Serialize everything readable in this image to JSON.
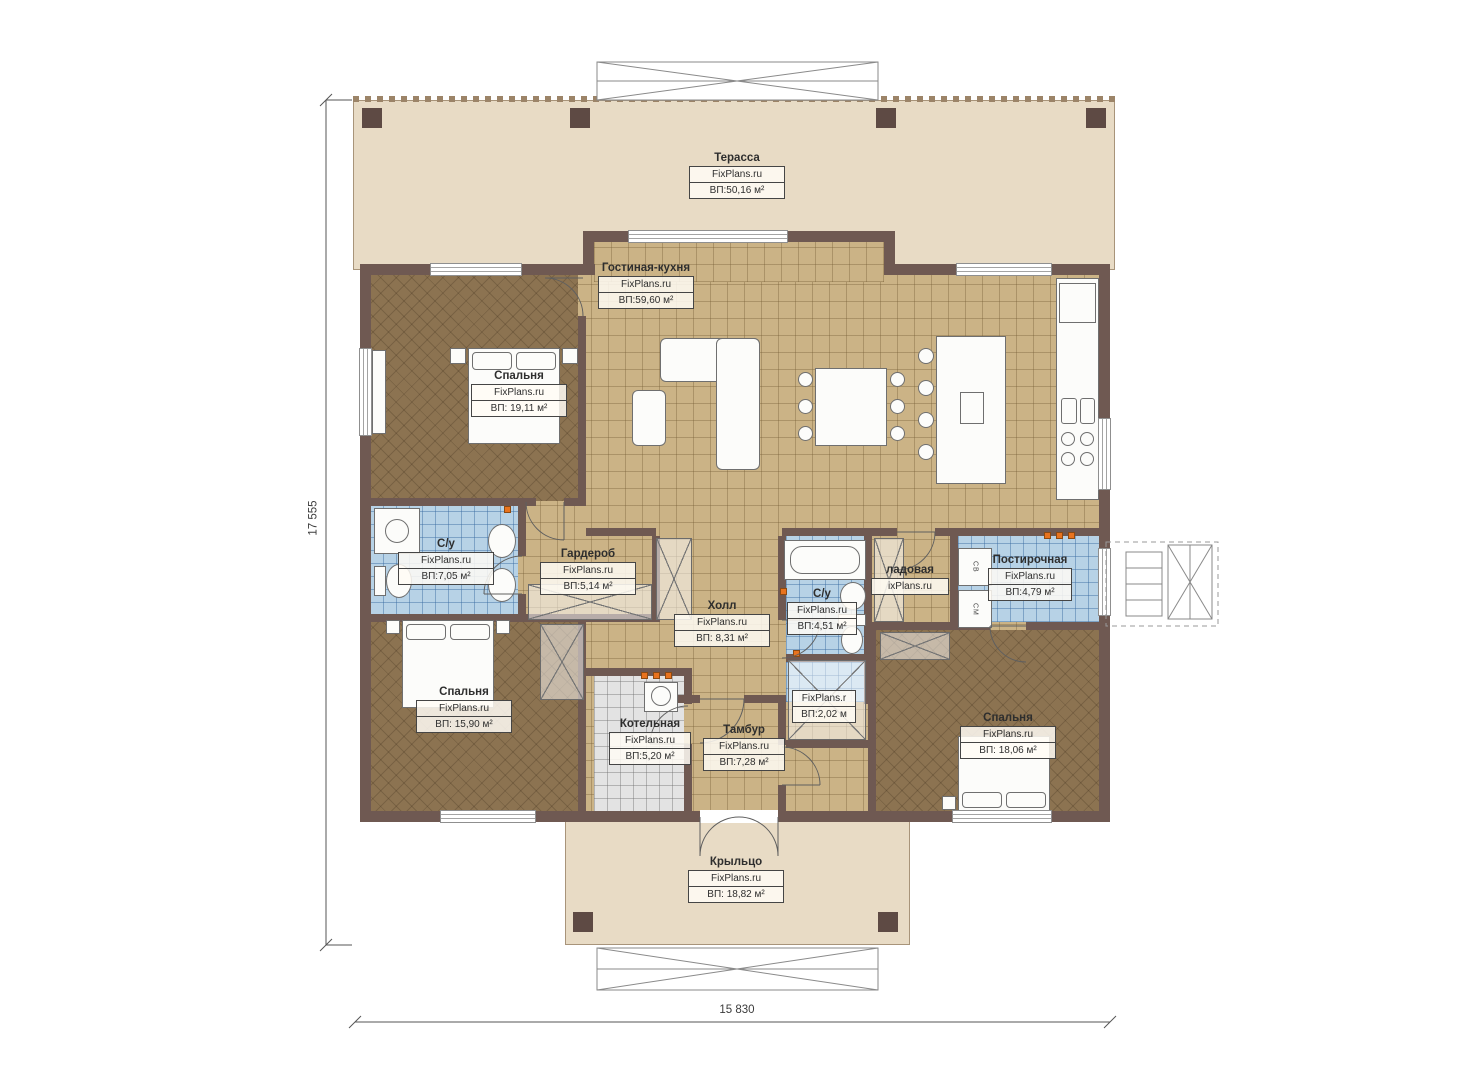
{
  "plan": {
    "dimensions": {
      "width": "15 830",
      "height": "17 555"
    },
    "rooms": [
      {
        "id": "terrace",
        "name": "Терасса",
        "brand": "FixPlans.ru",
        "area": "ВП:50,16 м²"
      },
      {
        "id": "living-kitchen",
        "name": "Гостиная-кухня",
        "brand": "FixPlans.ru",
        "area": "ВП:59,60 м²"
      },
      {
        "id": "bedroom-1",
        "name": "Спальня",
        "brand": "FixPlans.ru",
        "area": "ВП: 19,11 м²"
      },
      {
        "id": "bathroom-1",
        "name": "С/у",
        "brand": "FixPlans.ru",
        "area": "ВП:7,05 м²"
      },
      {
        "id": "wardrobe-room",
        "name": "Гардероб",
        "brand": "FixPlans.ru",
        "area": "ВП:5,14 м²"
      },
      {
        "id": "hall",
        "name": "Холл",
        "brand": "FixPlans.ru",
        "area": "ВП: 8,31 м²"
      },
      {
        "id": "bathroom-2",
        "name": "С/у",
        "brand": "FixPlans.ru",
        "area": "ВП:4,51 м²"
      },
      {
        "id": "pantry",
        "name": "ладовая",
        "brand": "ixPlans.ru",
        "area": ""
      },
      {
        "id": "laundry",
        "name": "Постирочная",
        "brand": "FixPlans.ru",
        "area": "ВП:4,79 м²"
      },
      {
        "id": "bedroom-2",
        "name": "Спальня",
        "brand": "FixPlans.ru",
        "area": "ВП: 15,90 м²"
      },
      {
        "id": "boiler-room",
        "name": "Котельная",
        "brand": "FixPlans.ru",
        "area": "ВП:5,20 м²"
      },
      {
        "id": "vestibule",
        "name": "Тамбур",
        "brand": "FixPlans.ru",
        "area": "ВП:7,28 м²"
      },
      {
        "id": "closet",
        "name": "",
        "brand": "FixPlans.r",
        "area": "ВП:2,02 м"
      },
      {
        "id": "bedroom-3",
        "name": "Спальня",
        "brand": "FixPlans.ru",
        "area": "ВП: 18,06 м²"
      },
      {
        "id": "porch",
        "name": "Крыльцо",
        "brand": "FixPlans.ru",
        "area": "ВП: 18,82 м²"
      }
    ],
    "appliances": {
      "dryer": "СВ",
      "washer": "СМ"
    },
    "colors": {
      "wall": "#6f5952",
      "terrace": "#e8dbc5",
      "tile_tan": "#cbb386",
      "tile_blue": "#b7d2e6",
      "tile_grey": "#e3e3e3",
      "floor_brown": "#8c7351",
      "accent": "#e8731e"
    }
  }
}
